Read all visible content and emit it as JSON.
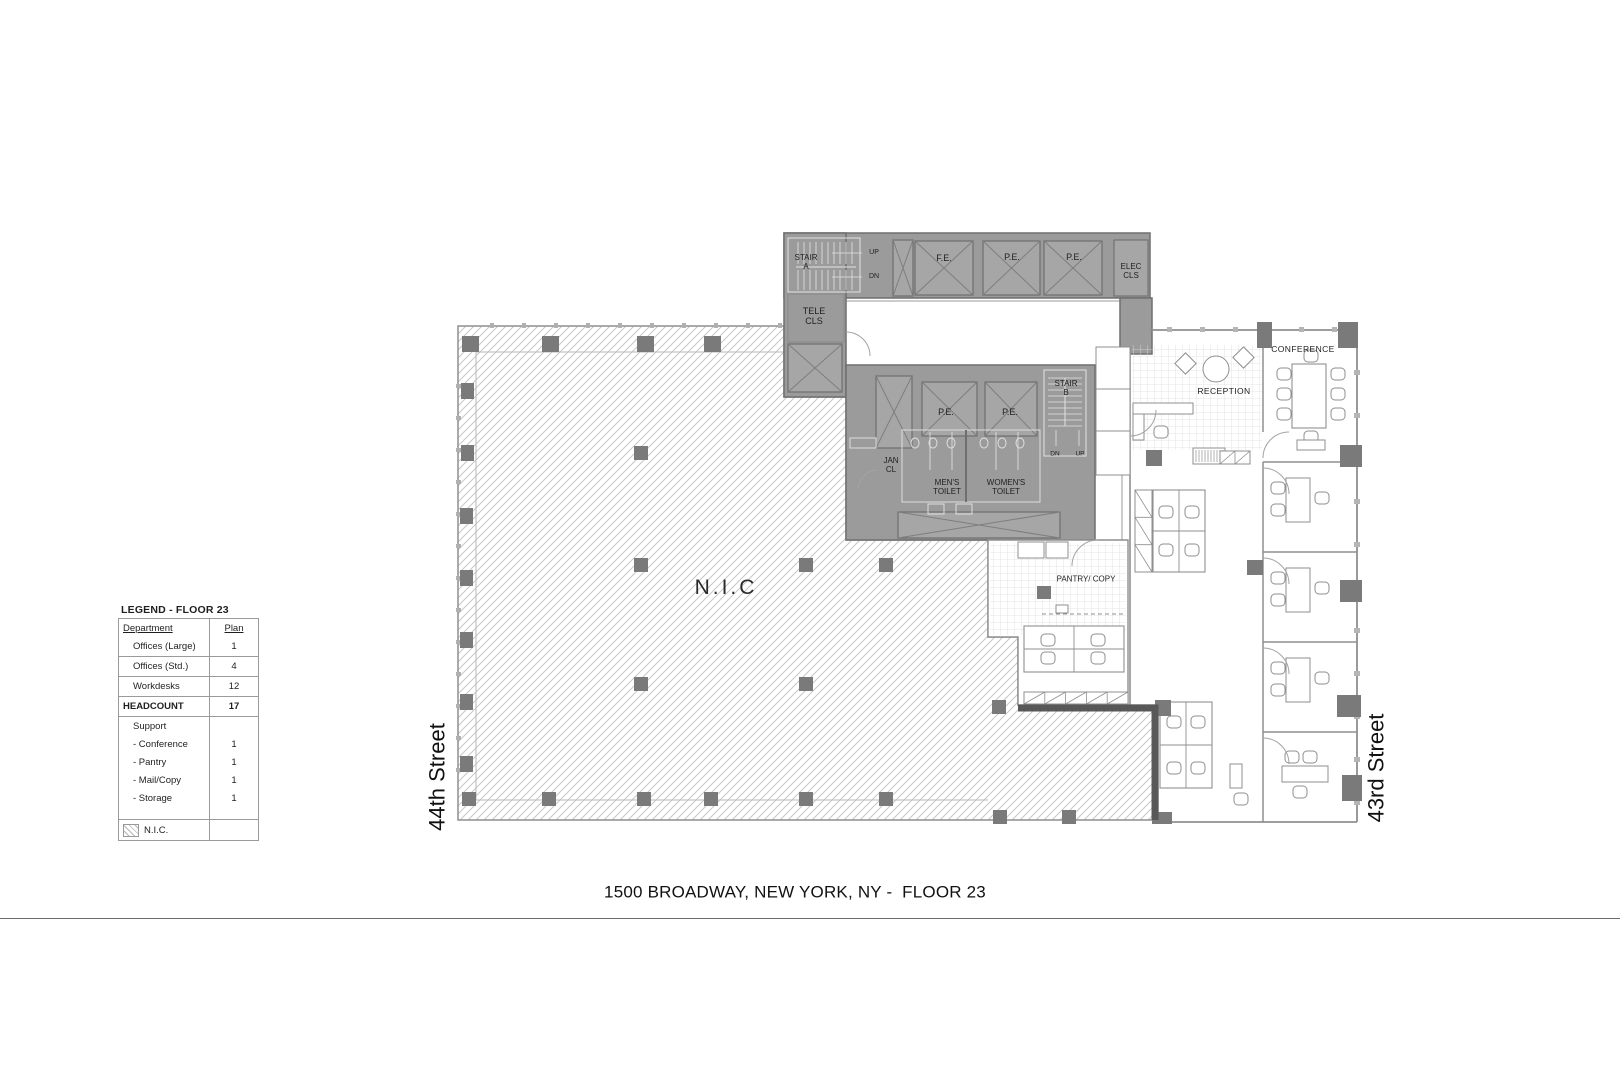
{
  "footer": {
    "title": "1500 BROADWAY, NEW YORK, NY -  FLOOR 23"
  },
  "streets": {
    "left": "44th Street",
    "right": "43rd Street"
  },
  "legend": {
    "title": "LEGEND - FLOOR 23",
    "header": {
      "department": "Department",
      "plan": "Plan"
    },
    "rows": [
      {
        "label": "Offices (Large)",
        "value": "1"
      },
      {
        "label": "Offices (Std.)",
        "value": "4"
      },
      {
        "label": "Workdesks",
        "value": "12"
      }
    ],
    "headcount": {
      "label": "HEADCOUNT",
      "value": "17"
    },
    "support": {
      "label": "Support",
      "items": [
        {
          "label": "- Conference",
          "value": "1"
        },
        {
          "label": "- Pantry",
          "value": "1"
        },
        {
          "label": "- Mail/Copy",
          "value": "1"
        },
        {
          "label": "- Storage",
          "value": "1"
        }
      ]
    },
    "nic": {
      "label": "N.I.C.",
      "value": ""
    }
  },
  "plan": {
    "labels": {
      "stair_a": "STAIR\nA",
      "up": "UP",
      "dn": "DN",
      "fe": "F.E.",
      "pe": "P.E.",
      "elec_cls": "ELEC\nCLS",
      "tele_cls": "TELE\nCLS",
      "stair_b": "STAIR\nB",
      "jan_cl": "JAN\nCL",
      "mens_toilet": "MEN'S\nTOILET",
      "womens_toilet": "WOMEN'S\nTOILET",
      "pantry_copy": "PANTRY/ COPY",
      "reception": "RECEPTION",
      "conference": "CONFERENCE",
      "nic": "N.I.C"
    }
  },
  "colors": {
    "core_fill": "#9b9b9b",
    "shaft_fill": "#a6a6a6",
    "core_stroke": "#6f6f6f",
    "x_stroke": "#7e7e7e",
    "wall": "#8f8f8f",
    "furniture": "#8f8f8f",
    "fixture_light": "#dedede",
    "column": "#7a7a7a",
    "hatch_line": "#c7c7c7",
    "grid_line": "#dcdcdc",
    "thick_wall": "#585858",
    "arc": "#a3a3a3"
  }
}
